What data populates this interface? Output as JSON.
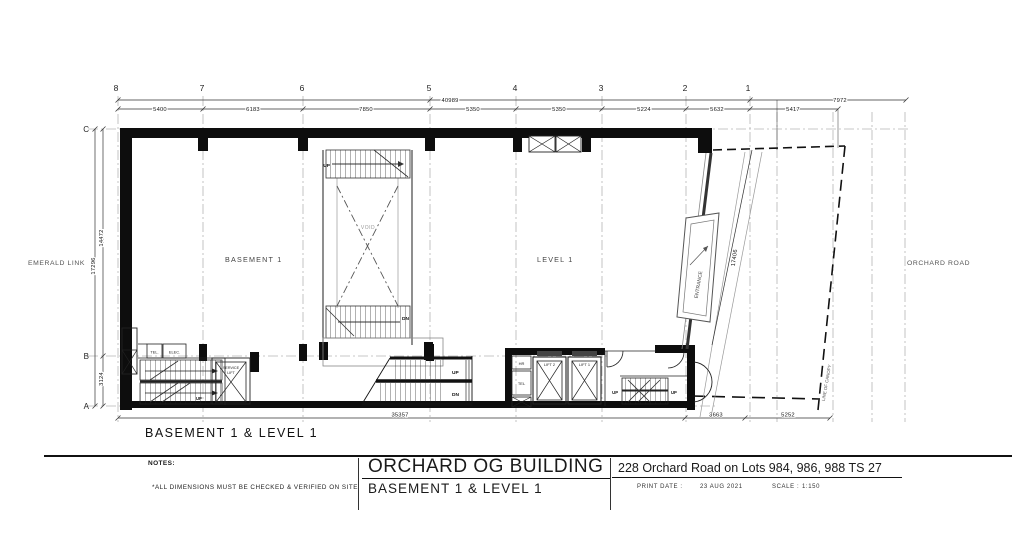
{
  "drawing": {
    "grid_columns": [
      "8",
      "7",
      "6",
      "5",
      "4",
      "3",
      "2",
      "1"
    ],
    "grid_rows": [
      "C",
      "B",
      "A"
    ],
    "dims_top": [
      "5400",
      "6183",
      "7850",
      "5350",
      "5350",
      "5224",
      "5632",
      "5417"
    ],
    "dim_total_top": "40989",
    "dim_canopy_top": "7972",
    "dim_left_total": "17296",
    "dim_left_cb": "14472",
    "dim_left_ba": "3124",
    "dim_bottom_total": "35357",
    "dim_bottom_1": "3663",
    "dim_bottom_2": "5252",
    "dim_entrance": "17406",
    "label_emerald": "EMERALD LINK",
    "label_orchard": "ORCHARD ROAD",
    "label_basement": "BASEMENT 1",
    "label_level": "LEVEL 1",
    "label_void": "VOID",
    "label_entrance": "ENTRANCE",
    "label_canopy": "LINE OF CANOPY",
    "label_up": "UP",
    "label_dn": "DN",
    "rooms": {
      "tel_b1": "TEL.",
      "elec": "ELEC.",
      "service_lift_1": "SERVICE",
      "service_lift_2": "LIFT",
      "hr": "HR",
      "tel_l1": "TEL",
      "lift2": "LIFT 2",
      "lift1": "LIFT 1"
    },
    "caption": "BASEMENT 1 & LEVEL 1"
  },
  "titleblock": {
    "notes_label": "NOTES:",
    "notes_text": "*ALL DIMENSIONS MUST BE CHECKED & VERIFIED ON SITE",
    "project": "ORCHARD OG BUILDING",
    "drawing_name": "BASEMENT 1 & LEVEL 1",
    "address": "228 Orchard Road on Lots 984, 986, 988 TS 27",
    "print_date_label": "PRINT DATE   :",
    "print_date": "23 AUG 2021",
    "scale_label": "SCALE :",
    "scale": "1:150"
  }
}
